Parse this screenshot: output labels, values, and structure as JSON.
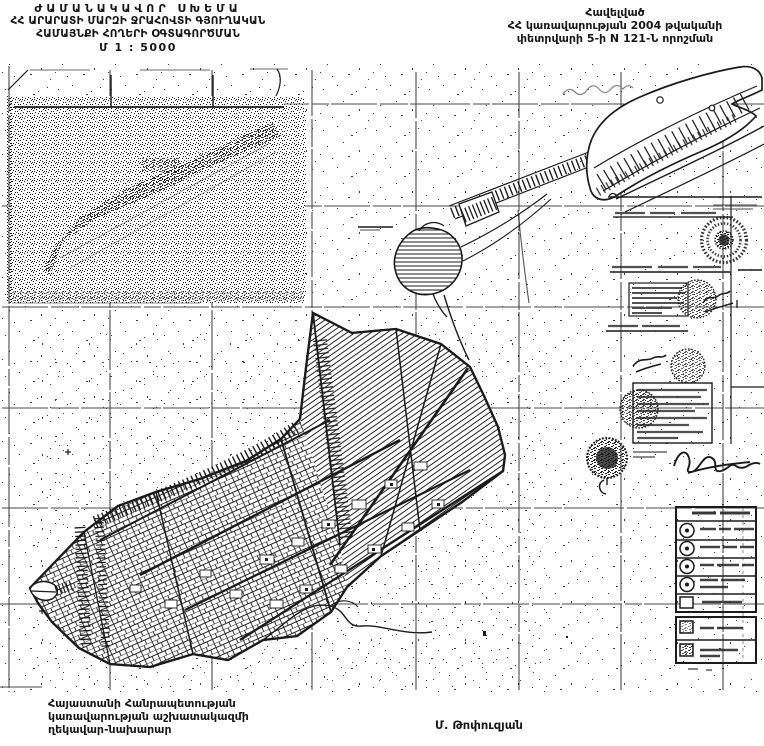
{
  "document": {
    "header": {
      "title_block": {
        "line1": "ԺԱՄԱՆԱԿԱՎՈՐ ՍԽԵՄԱ",
        "line2": "ՀՀ ԱՐԱՐԱՏԻ ՄԱՐԶԻ ՋՐԱՀՈՎՏԻ ԳՅՈՒՂԱԿԱՆ",
        "line3": "ՀԱՄԱՅՆՔԻ ՀՈՂԵՐԻ ՕԳՏԱԳՈՐԾՄԱՆ",
        "scale": "Մ 1 : 5000"
      },
      "annex_block": {
        "line1": "Հավելված",
        "line2": "ՀՀ կառավարության 2004 թվականի",
        "line3": "փետրվարի 5-ի N 121-Ն որոշման"
      }
    },
    "footer": {
      "office_block": {
        "line1": "Հայաստանի Հանրապետության",
        "line2": "կառավարության աշխատակազմի",
        "line3": "ղեկավար-նախարար"
      },
      "signatory": "Մ. Թոփուզյան"
    },
    "map": {
      "legend": {
        "rows": [
          {
            "symbol": "circle"
          },
          {
            "symbol": "circle"
          },
          {
            "symbol": "circle"
          },
          {
            "symbol": "circle"
          },
          {
            "symbol": "square"
          },
          {
            "symbol": "square"
          },
          {
            "symbol": "square"
          }
        ]
      },
      "stamps": [
        {
          "kind": "concentric-round-seal"
        },
        {
          "kind": "dotted-stamp-over-text-block"
        },
        {
          "kind": "dotted-stamp-over-text-block"
        },
        {
          "kind": "dark-round-stamp"
        },
        {
          "kind": "handwritten-signature"
        }
      ]
    },
    "colors": {
      "paper": "#ffffff",
      "ink": "#1b1b1b"
    }
  }
}
